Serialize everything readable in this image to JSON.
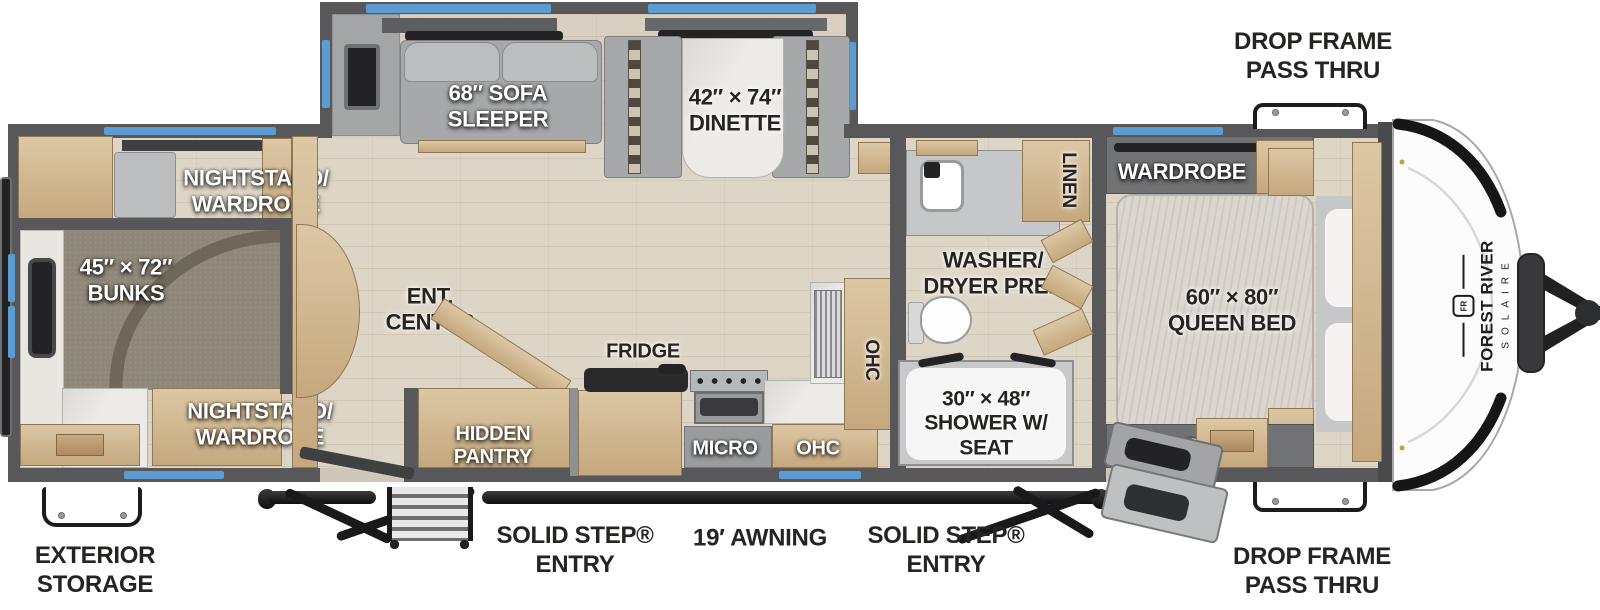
{
  "title": "Forest River Solaire travel trailer floorplan",
  "colors": {
    "wall_gray": "#58585a",
    "floor_wood": "#ddd5c6",
    "carpet": "#8f877a",
    "cabinet_wood": "#d5bf9c",
    "upholstery": "#a7a8aa",
    "marble": "#edebe7",
    "window_blue": "#5d9bd3",
    "label_dark": "#272320",
    "label_light": "#ffffff"
  },
  "exterior": {
    "drop_frame_top": "DROP FRAME\nPASS THRU",
    "drop_frame_bottom": "DROP FRAME\nPASS THRU",
    "exterior_storage": "EXTERIOR\nSTORAGE",
    "entry_left": "SOLID STEP®\nENTRY",
    "awning": "19′ AWNING",
    "entry_right": "SOLID STEP®\nENTRY"
  },
  "rooms": {
    "living": {
      "sofa": "68″ SOFA\nSLEEPER",
      "dinette": "42″ × 74″\nDINETTE",
      "ent_center": "ENT.\nCENTER",
      "hidden_pantry": "HIDDEN\nPANTRY"
    },
    "kitchen": {
      "fridge": "FRIDGE",
      "micro": "MICRO",
      "ohc_lower": "OHC",
      "ohc_upper": "OHC"
    },
    "bunk_room": {
      "nightstand_top": "NIGHTSTAND/\nWARDROBE",
      "bunks": "45″ × 72″\nBUNKS",
      "nightstand_bottom": "NIGHTSTAND/\nWARDROBE"
    },
    "bathroom": {
      "washer_dryer": "WASHER/\nDRYER PREP",
      "linen": "LINEN",
      "shower": "30″ × 48″\nSHOWER W/\nSEAT"
    },
    "bedroom": {
      "wardrobe_top": "WARDROBE",
      "queen_bed": "60″ × 80″\nQUEEN BED",
      "wardrobe_bottom": "WARDROBE",
      "ohc": "OHC"
    }
  },
  "brand": {
    "logo_text": "FR",
    "name": "FOREST RIVER",
    "model": "SOLAIRE"
  }
}
